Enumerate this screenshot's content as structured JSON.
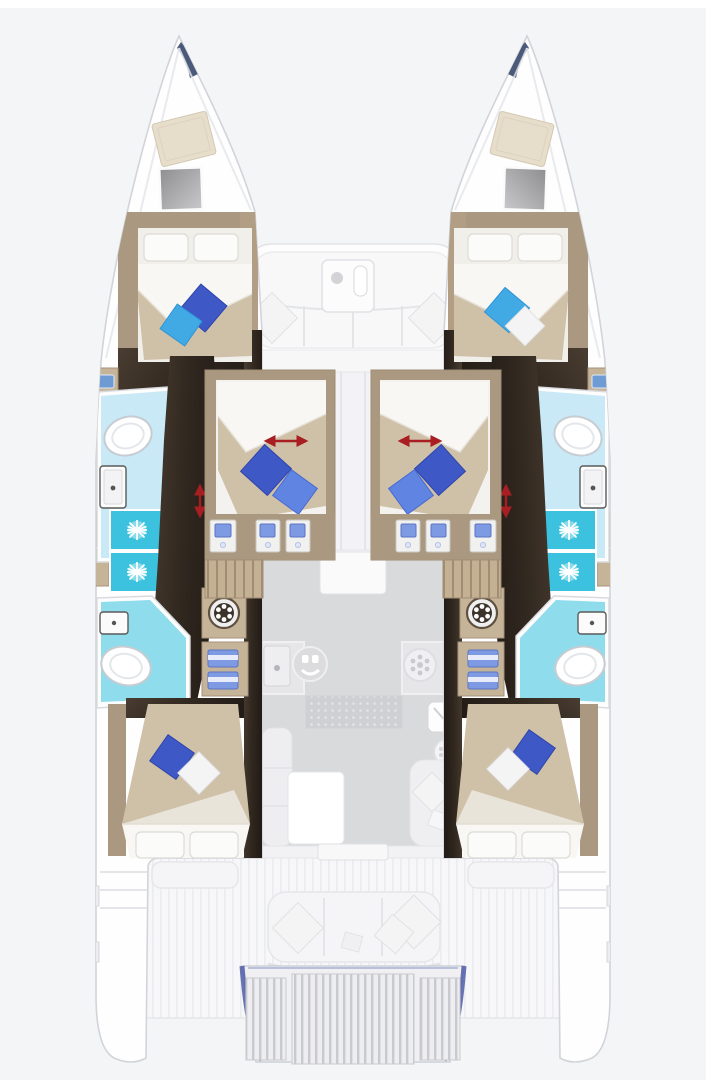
{
  "meta": {
    "title": "Catamaran 6-cabin deck layout plan, top view",
    "type": "floorplan",
    "canvas": {
      "width": 706,
      "height": 1080
    }
  },
  "colors": {
    "bg": "#f4f5f6",
    "hull_outline": "#d2d4d9",
    "wood_tan": "#ab9880",
    "wood_tan_light": "#c6b499",
    "wood_dark_1": "#46392e",
    "wood_dark_2": "#261f18",
    "bed_beige": "#cfc0a8",
    "linen": "#fbfbfa",
    "pillow_navy": "#3e58c5",
    "pillow_blue": "#5f84e2",
    "pillow_cyan": "#41aae4",
    "bath_floor": "#c9e9f6",
    "bath_floor_deep": "#8edcec",
    "shower_cyan": "#3cc2de",
    "arrow_red": "#a81e22",
    "towel_blue": "#7e9ae2",
    "salon_floor": "#d9dadc",
    "deck_white": "#f7f7f9",
    "transom_blue": "#4d5ca6"
  },
  "layout": {
    "hulls": [
      "port",
      "starboard"
    ],
    "cabins": [
      {
        "id": "forward-port",
        "bed": "double",
        "accent_pillows": [
          "navy",
          "cyan"
        ]
      },
      {
        "id": "forward-starboard",
        "bed": "double",
        "accent_pillows": [
          "cyan",
          "white"
        ]
      },
      {
        "id": "mid-port",
        "bed": "double-angled",
        "accent_pillows": [
          "navy",
          "blue"
        ],
        "annotation": "red-dimension-arrow"
      },
      {
        "id": "mid-starboard",
        "bed": "double-angled",
        "accent_pillows": [
          "navy",
          "blue"
        ],
        "annotation": "red-dimension-arrow"
      },
      {
        "id": "aft-port",
        "bed": "double",
        "accent_pillows": [
          "navy",
          "white"
        ]
      },
      {
        "id": "aft-starboard",
        "bed": "double",
        "accent_pillows": [
          "navy",
          "white"
        ]
      }
    ],
    "bathrooms": [
      {
        "id": "port-forward",
        "fixtures": [
          "toilet",
          "sink",
          "shower",
          "shower"
        ]
      },
      {
        "id": "port-aft",
        "fixtures": [
          "toilet",
          "sink"
        ]
      },
      {
        "id": "starboard-forward",
        "fixtures": [
          "toilet",
          "sink",
          "shower",
          "shower"
        ]
      },
      {
        "id": "starboard-aft",
        "fixtures": [
          "toilet",
          "sink"
        ]
      }
    ],
    "utilities": [
      {
        "id": "washer-port"
      },
      {
        "id": "washer-starboard"
      },
      {
        "id": "towel-locker-port",
        "towels": 2
      },
      {
        "id": "towel-locker-starboard",
        "towels": 2
      }
    ],
    "bow": {
      "hatches_per_hull": [
        "sail-locker-hatch",
        "deck-hatch"
      ],
      "trampoline": false
    },
    "forward_cockpit": {
      "furniture": [
        "u-sofa",
        "table",
        "cushion-left",
        "cushion-right"
      ]
    },
    "galley": {
      "fixtures": [
        "sink",
        "hob",
        "burner"
      ],
      "floor_mat": "dotted"
    },
    "salon": {
      "furniture": [
        "l-sofa",
        "dining-table",
        "nav-seat",
        "fridge",
        "round-sink"
      ]
    },
    "aft_cockpit": {
      "furniture": [
        "side-bench-port",
        "side-bench-starboard",
        "aft-bench",
        "cushions"
      ]
    },
    "swim_platform": {
      "grating_panels": 3,
      "outline": "blue"
    },
    "stairs": {
      "count": 2,
      "location": "mid-cabins-to-hulls"
    },
    "annotations": {
      "red_arrows_total": 4
    }
  }
}
